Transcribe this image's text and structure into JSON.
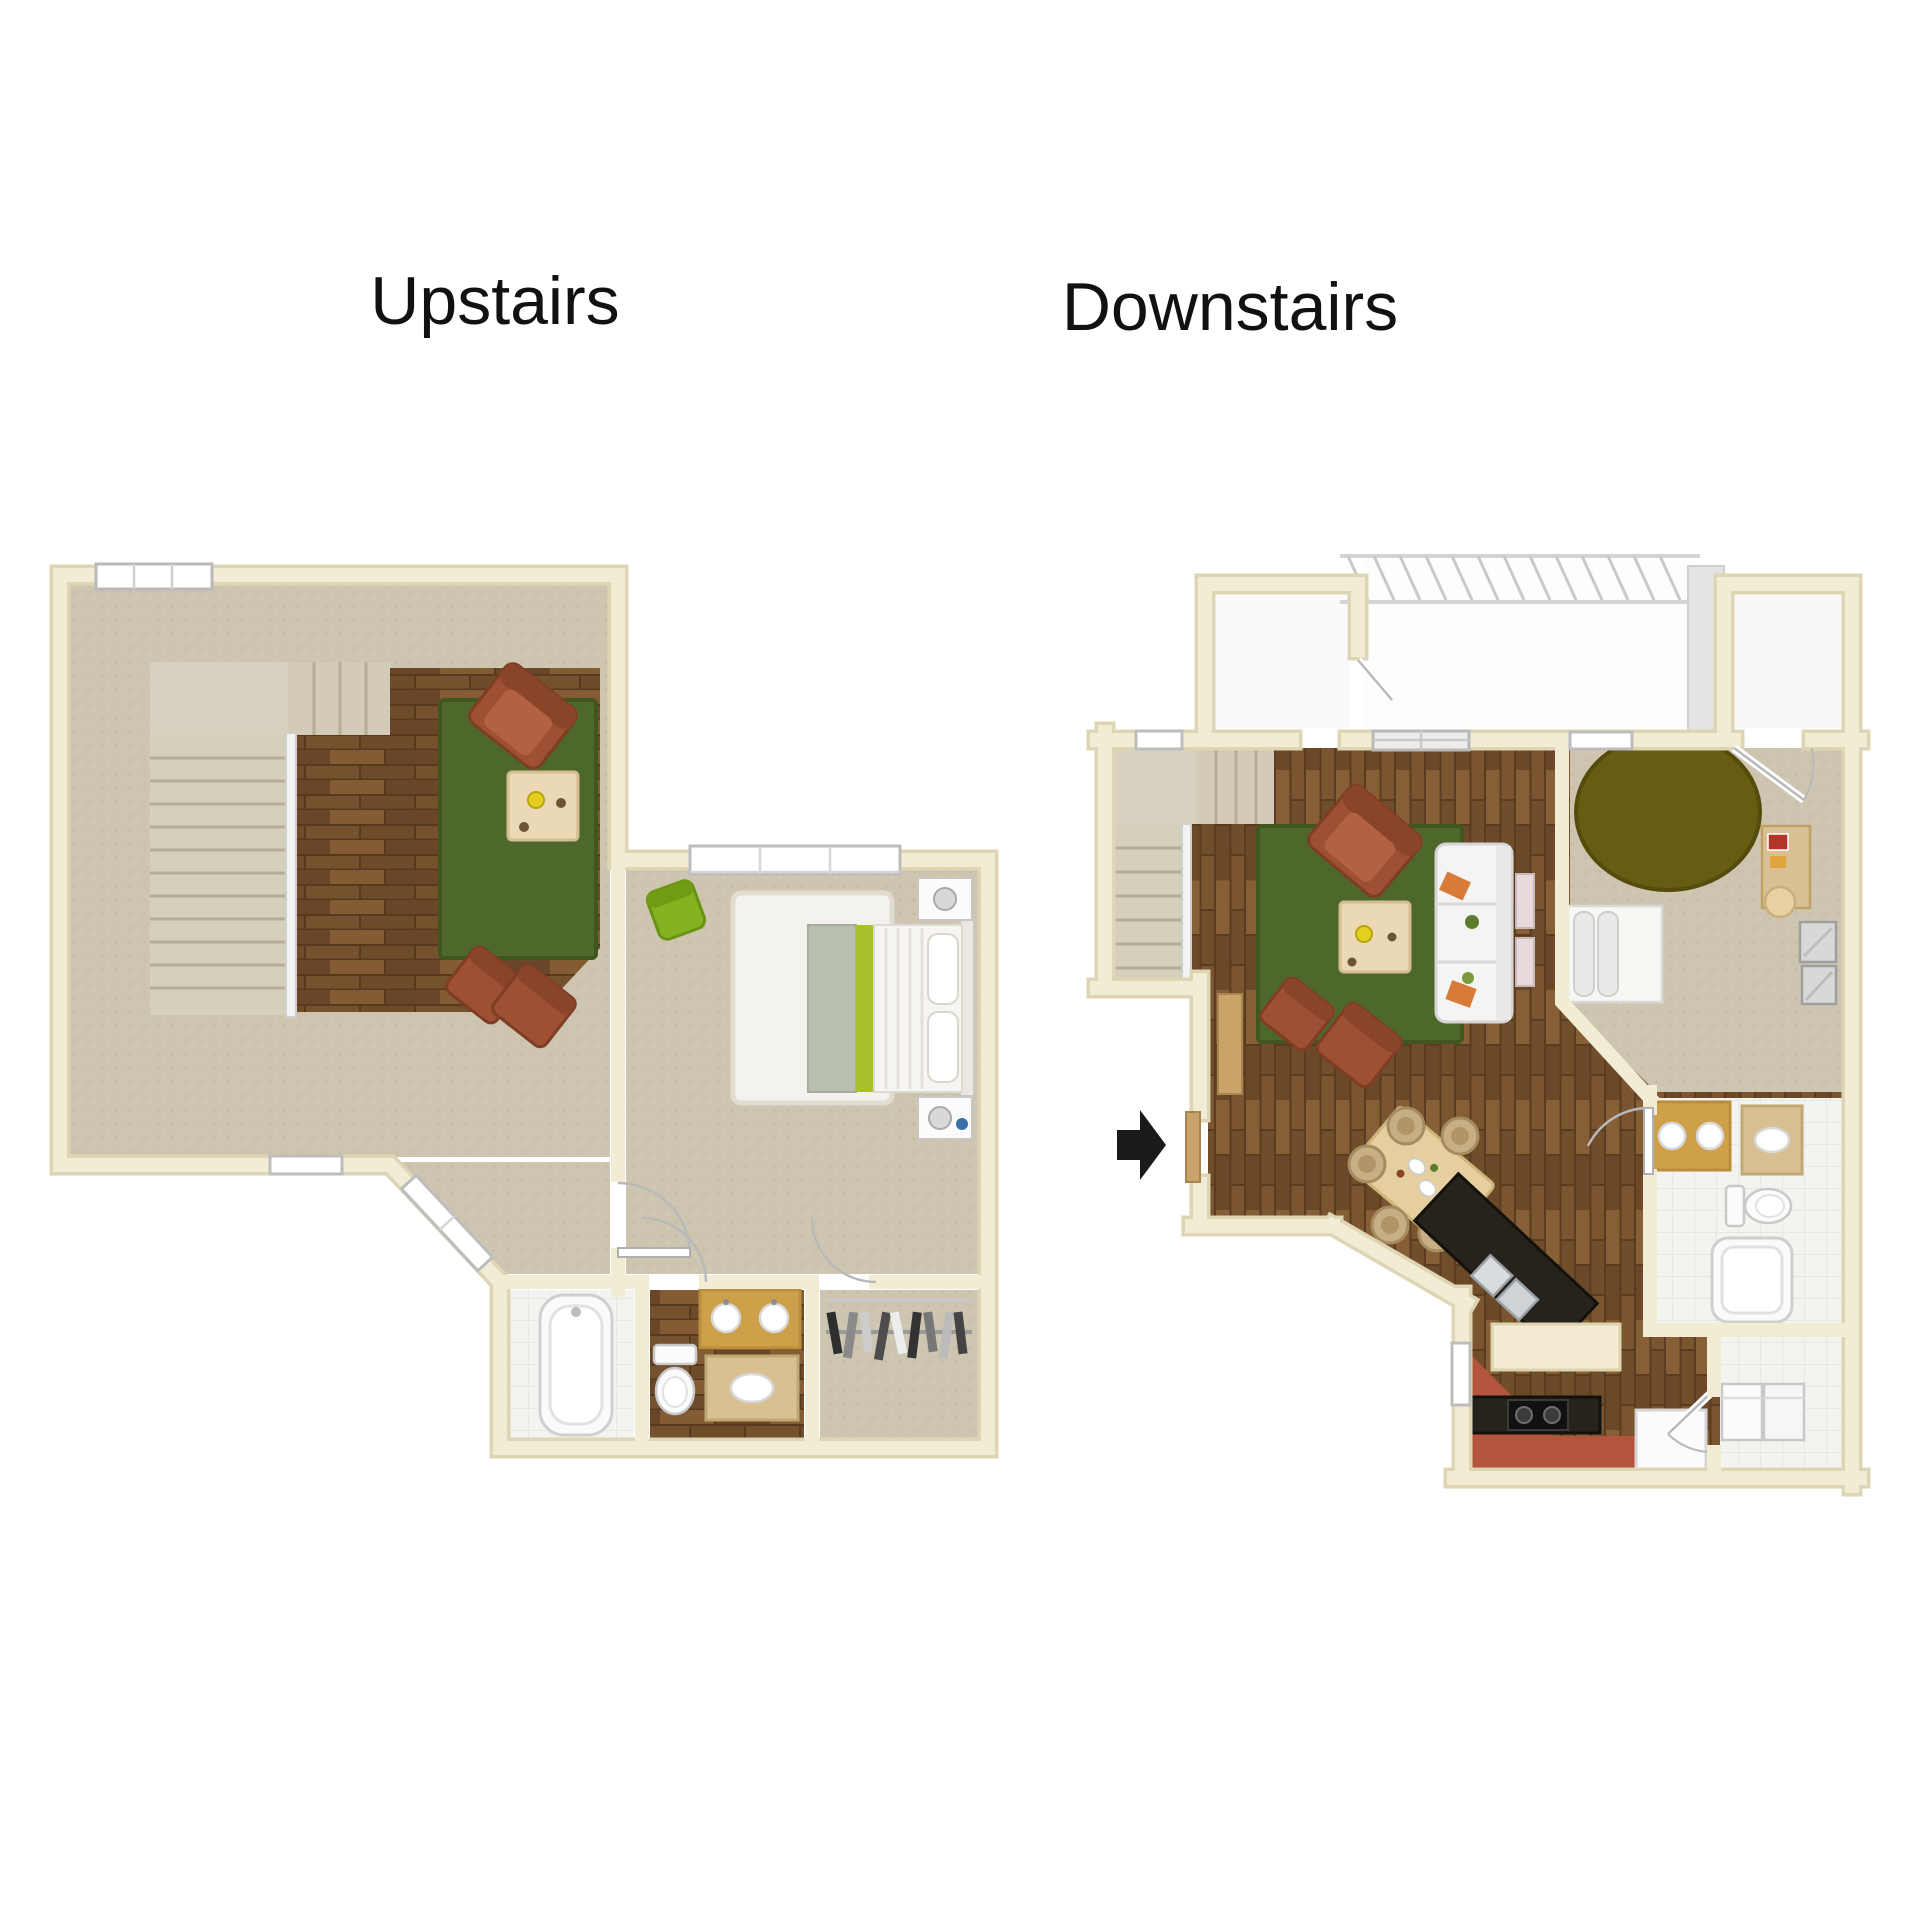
{
  "titles": {
    "upstairs": "Upstairs",
    "downstairs": "Downstairs"
  },
  "icons": {
    "entry_arrow": "entry-arrow-icon"
  },
  "palette": {
    "title_text": "#111111",
    "wall_cream": "#f2ecd5",
    "wall_edge": "#ded5b5",
    "carpet": "#cdc5b0",
    "stair_carpet": "#d8d1bf",
    "wood_base": "#75512d",
    "rug_green": "#4e682c",
    "rug_olive": "#665c12",
    "chair_rust": "#9e5033",
    "chair_green": "#84b220",
    "accent_lime": "#a8c22e",
    "sofa_white": "#f4f4f4",
    "coffee_table_wood": "#ead9b4",
    "dining_table_wood": "#e5cf9e",
    "counter_black": "#26221c",
    "kitchen_floor_red": "#b3553c",
    "vanity_gold": "#cfa04a",
    "counter_tan": "#d8c092",
    "fixture_white": "#fbfbfb",
    "tile_white": "#f3f3f0",
    "pergola_gray": "#c9c9c9",
    "arrow_black": "#1a1a1a"
  }
}
